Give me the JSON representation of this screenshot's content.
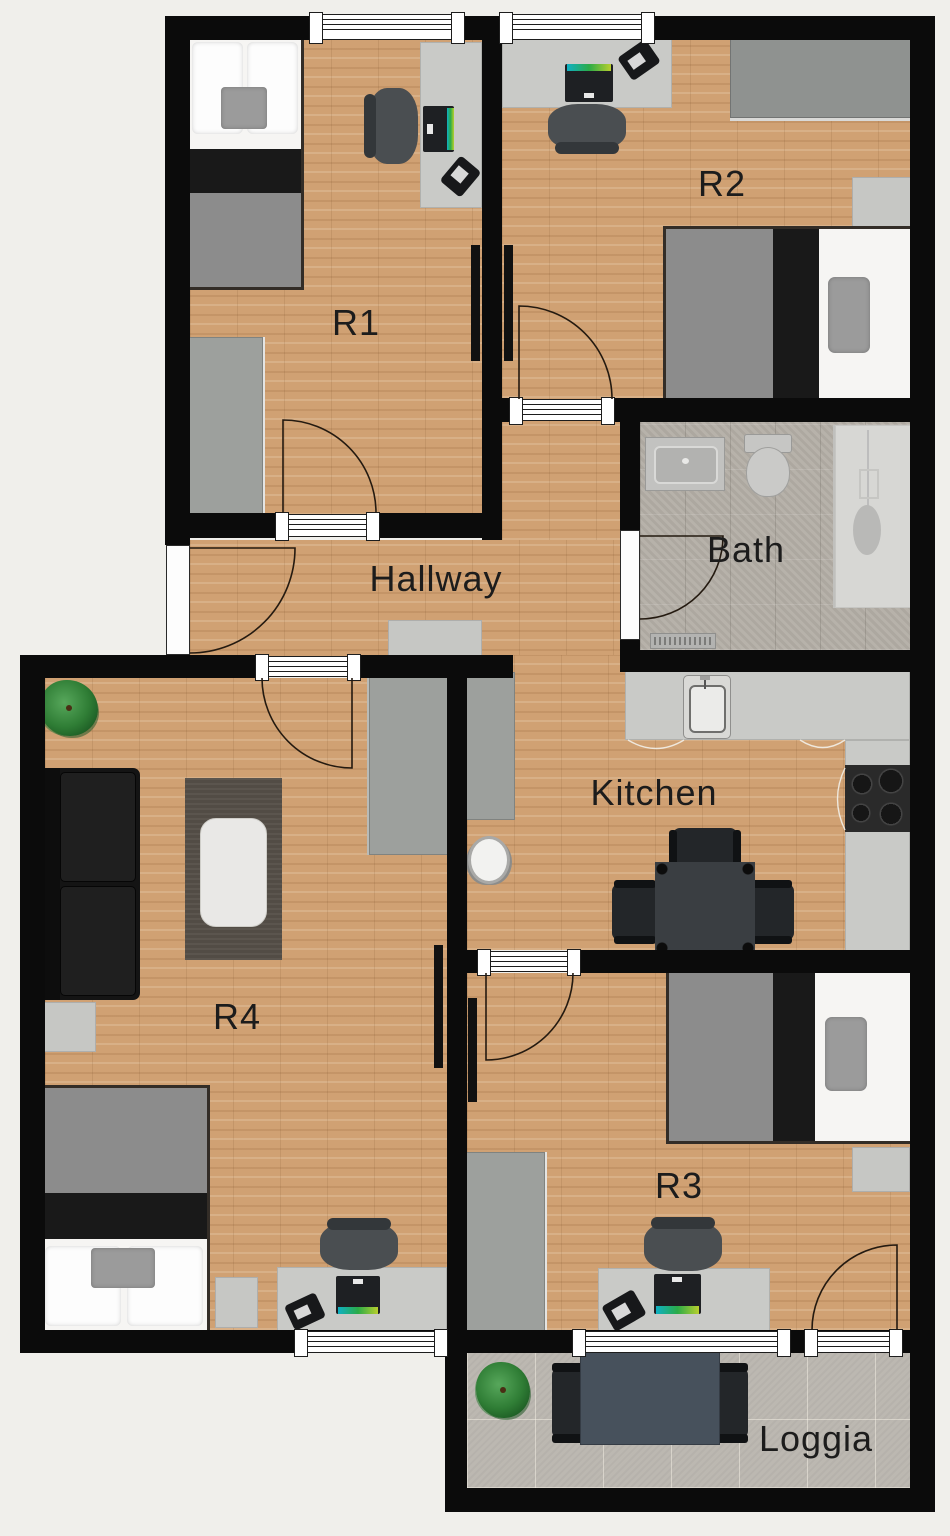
{
  "plan": {
    "title": "Apartment floor plan",
    "rooms": [
      {
        "id": "r1",
        "label": "R1"
      },
      {
        "id": "r2",
        "label": "R2"
      },
      {
        "id": "hallway",
        "label": "Hallway"
      },
      {
        "id": "bath",
        "label": "Bath"
      },
      {
        "id": "kitchen",
        "label": "Kitchen"
      },
      {
        "id": "r4",
        "label": "R4"
      },
      {
        "id": "r3",
        "label": "R3"
      },
      {
        "id": "loggia",
        "label": "Loggia"
      }
    ],
    "colors": {
      "background": "#f0efeb",
      "wall": "#0b0b0b",
      "wood_floor": "#d0a173",
      "bath_floor": "#b4afa7",
      "loggia_floor": "#bcb8b1",
      "monitor_screen_accent": "#0fb0c4",
      "plant_green": "#2f7d35",
      "label_text": "#1c1c1c"
    }
  }
}
